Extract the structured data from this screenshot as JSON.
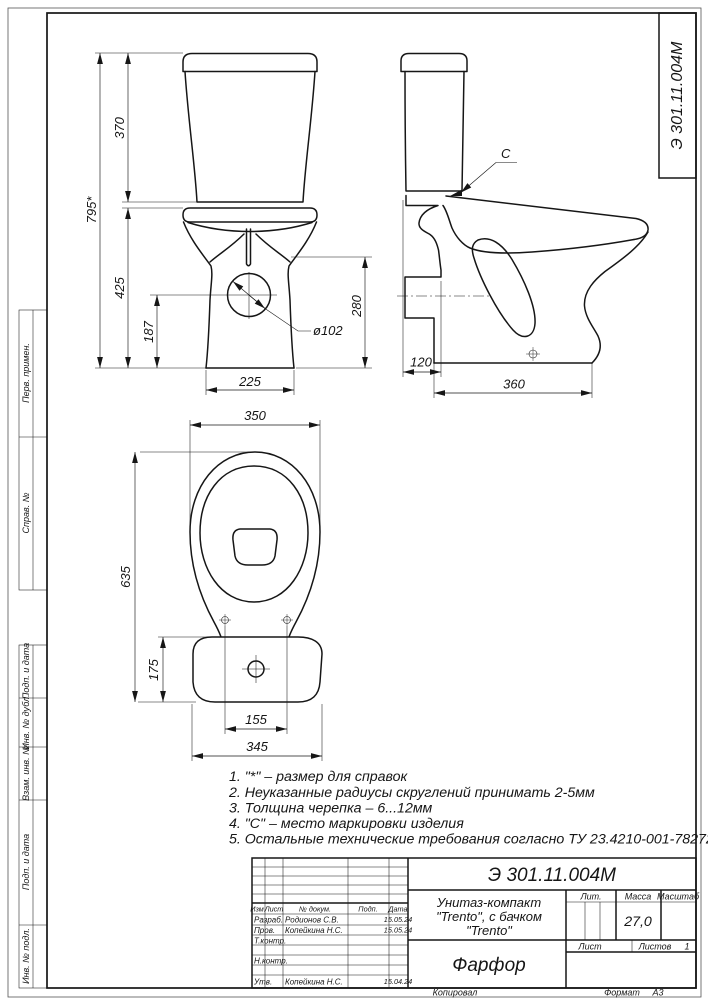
{
  "doc": {
    "number": "Э 301.11.004М",
    "material": "Фарфор",
    "product_title_line1": "Унитаз-компакт",
    "product_title_line2": "\"Trento\", с бачком",
    "product_title_line3": "\"Trento\"",
    "mass": "27,0",
    "sheets_count": "1",
    "copied_label": "Копировал",
    "format_label": "Формат",
    "format_value": "А3"
  },
  "margin_labels": [
    "Перв. примен.",
    "Справ. №",
    "Подп. и дата",
    "Инв. № дубл.",
    "Взам. инв. №",
    "Подп. и дата",
    "Инв. № подл."
  ],
  "title_block": {
    "col_headers": {
      "izm": "Изм.",
      "list": "Лист",
      "doc": "№ докум.",
      "sign": "Подп.",
      "date": "Дата"
    },
    "rows": [
      {
        "role": "Разраб.",
        "name": "Родионов С.В.",
        "date": "15.05.24"
      },
      {
        "role": "Пров.",
        "name": "Копейкина Н.С.",
        "date": "15.05.24"
      },
      {
        "role": "Т.контр.",
        "name": "",
        "date": ""
      },
      {
        "role": "Н.контр.",
        "name": "",
        "date": ""
      },
      {
        "role": "Утв.",
        "name": "Копейкина Н.С.",
        "date": "15.04.24"
      }
    ],
    "lit_label": "Лит.",
    "mass_label": "Масса",
    "scale_label": "Масштаб",
    "sheet_label": "Лист",
    "sheets_label": "Листов"
  },
  "notes": [
    "1. \"*\" – размер для справок",
    "2. Неуказанные радиусы скруглений принимать 2-5мм",
    "3. Толщина черепка – 6...12мм",
    "4. \"С\" – место маркировки изделия",
    "5.  Остальные технические требования согласно ТУ 23.4210-001-78272202"
  ],
  "dims": {
    "front": {
      "overall_height": "795*",
      "tank_height": "370",
      "bowl_height": "425",
      "outlet_height": "187",
      "shelf_height": "280",
      "base_width": "225",
      "outlet_diameter": "ø102"
    },
    "side": {
      "mark": "C",
      "rear_offset": "120",
      "base_length": "360"
    },
    "plan": {
      "rim_width": "350",
      "overall_length": "635",
      "tank_overhang": "175",
      "bolt_spacing": "155",
      "tank_width": "345"
    }
  }
}
